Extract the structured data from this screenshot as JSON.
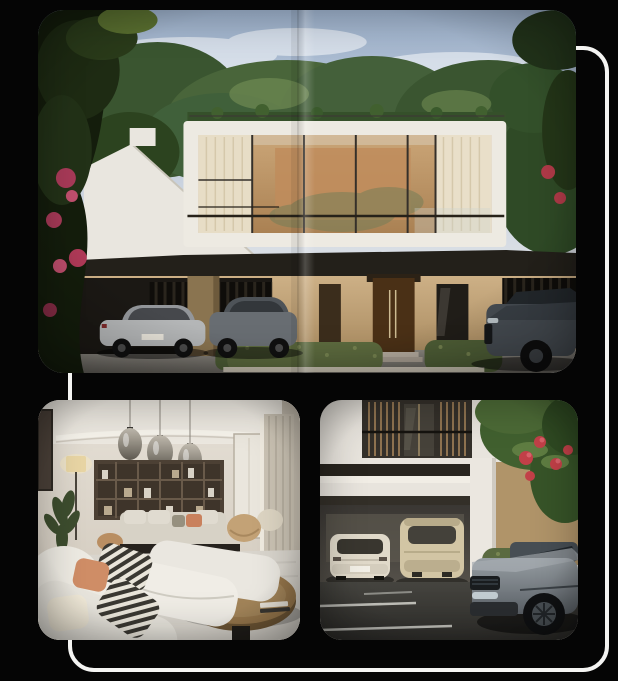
{
  "theme": {
    "background": "#050505",
    "outline_color": "#f4f4f2"
  },
  "gallery": {
    "name": "property-photo-collage",
    "images": [
      {
        "id": "villa-exterior",
        "alt": "Modern two-storey villa with a full-width glass upper floor, rooftop greenery, dark carport with two parked cars, beige entrance walls, hedges and a grey SUV, surrounded by trees and pink blossoms"
      },
      {
        "id": "living-room",
        "alt": "Contemporary living room with white sectional sofas, striped and terracotta cushions, smoked-glass pendant lamps, dark wood shelving unit, floor lamp, plant and an oval wooden coffee table"
      },
      {
        "id": "garage-driveway",
        "alt": "Villa garage with a white saloon and a beige SUV parked inside, balcony above, flowering tree and hedge beside a grey SUV on the dark driveway"
      }
    ],
    "palette": {
      "sky": "#aebdd1",
      "foliage": "#3f5c30",
      "facade_white": "#ece8e0",
      "facade_tan": "#c3a67c",
      "glass_amber": "#c0905f",
      "interior_cream": "#eceae3",
      "accent_terracotta": "#cd8a64",
      "blossom_pink": "#b03a58",
      "asphalt": "#3d3c38"
    }
  }
}
